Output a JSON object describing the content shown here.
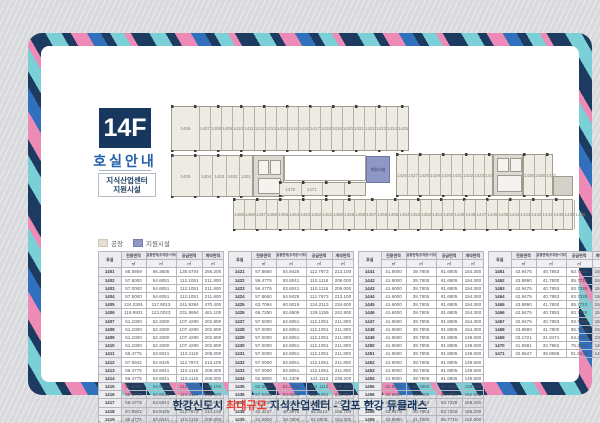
{
  "header": {
    "floor": "14F",
    "subtitle": "호실안내",
    "box_line1": "지식산업센터",
    "box_line2": "지원시설"
  },
  "legend": {
    "items": [
      {
        "label": "공장",
        "color": "#e6e0d2"
      },
      {
        "label": "지원시설",
        "color": "#8f97c5"
      }
    ]
  },
  "plan": {
    "support_label": "지원시설",
    "bands": {
      "top": [
        "1406",
        "1407",
        "1408",
        "1409",
        "1410",
        "1411",
        "1412",
        "1413",
        "1414",
        "1415",
        "1416",
        "1417",
        "1418",
        "1419",
        "1420",
        "1421",
        "1422",
        "1423",
        "1424",
        "1425"
      ],
      "mid_left": [
        "1405",
        "1404",
        "1403",
        "1402",
        "1401"
      ],
      "mid_right_a": [
        "1426",
        "1427",
        "1428",
        "1429",
        "1430",
        "1431",
        "1432",
        "1433",
        "1434"
      ],
      "mid_right_b": [
        "1435",
        "1436",
        "1437"
      ],
      "strip": [
        "1470",
        "1471",
        "",
        ""
      ],
      "bottom": [
        "1469",
        "1468",
        "1467",
        "1466",
        "1465",
        "1464",
        "1463",
        "1462",
        "1461",
        "1460",
        "1459",
        "1458",
        "1457",
        "1456",
        "1455",
        "1454",
        "1453",
        "1452",
        "1451",
        "1450",
        "1449",
        "1448",
        "1447",
        "1446",
        "1445",
        "1444",
        "1443",
        "1442",
        "1441",
        "1440",
        "1439",
        "1438"
      ]
    }
  },
  "table_header": {
    "room": "호실",
    "cols": [
      {
        "label": "전용면적",
        "unit": "㎡"
      },
      {
        "label": "공용면적(주차장+기타)",
        "unit": "㎡"
      },
      {
        "label": "공급면적",
        "unit": "㎡"
      },
      {
        "label": "계약면적",
        "unit": "㎡"
      }
    ]
  },
  "tables": [
    {
      "rows": [
        [
          "1401",
          "65.5869",
          "66.3605",
          "135.6704",
          "256.200"
        ],
        [
          "1402",
          "57.5000",
          "54.6051",
          "112.1051",
          "211.800"
        ],
        [
          "1403",
          "57.0000",
          "54.6051",
          "112.1051",
          "211.800"
        ],
        [
          "1404",
          "57.5000",
          "54.6051",
          "112.1051",
          "211.800"
        ],
        [
          "1405",
          "124.0391",
          "117.9013",
          "241.9394",
          "470.400"
        ],
        [
          "1406",
          "119.9931",
          "113.0023",
          "231.9954",
          "461.100"
        ],
        [
          "1407",
          "51.1000",
          "52.3290",
          "107.4290",
          "202.900"
        ],
        [
          "1408",
          "51.1000",
          "52.3290",
          "107.4290",
          "202.900"
        ],
        [
          "1409",
          "51.1000",
          "52.3290",
          "107.4290",
          "202.900"
        ],
        [
          "1410",
          "51.1000",
          "52.3290",
          "107.4290",
          "202.900"
        ],
        [
          "1411",
          "56.4775",
          "53.6041",
          "110.1116",
          "208.000"
        ],
        [
          "1412",
          "57.8942",
          "54.9425",
          "112.7973",
          "213.100"
        ],
        [
          "1413",
          "56.4775",
          "53.6041",
          "110.1116",
          "208.000"
        ],
        [
          "1414",
          "56.4775",
          "53.6041",
          "110.1116",
          "208.000"
        ],
        [
          "1415",
          "57.8942",
          "54.9425",
          "112.7973",
          "213.100"
        ],
        [
          "1416",
          "56.4775",
          "53.6041",
          "110.1116",
          "208.000"
        ],
        [
          "1417",
          "56.4775",
          "53.6041",
          "110.1116",
          "208.000"
        ],
        [
          "1418",
          "57.8942",
          "54.9425",
          "112.7973",
          "213.100"
        ],
        [
          "1419",
          "56.4775",
          "53.6041",
          "110.1116",
          "208.000"
        ],
        [
          "1420",
          "56.4775",
          "53.6041",
          "110.1116",
          "208.000"
        ]
      ]
    },
    {
      "rows": [
        [
          "1421",
          "57.8660",
          "54.9425",
          "112.7973",
          "213.100"
        ],
        [
          "1422",
          "56.4775",
          "53.6041",
          "110.1116",
          "208.000"
        ],
        [
          "1423",
          "56.4775",
          "53.6041",
          "110.1116",
          "208.000"
        ],
        [
          "1424",
          "57.8660",
          "54.9425",
          "112.7973",
          "213.100"
        ],
        [
          "1425",
          "63.7094",
          "60.5019",
          "124.2113",
          "234.600"
        ],
        [
          "1426",
          "66.7250",
          "62.6909",
          "129.1159",
          "242.900"
        ],
        [
          "1427",
          "57.5000",
          "54.6051",
          "112.1051",
          "211.800"
        ],
        [
          "1428",
          "57.0000",
          "54.6051",
          "112.1051",
          "211.800"
        ],
        [
          "1429",
          "57.0000",
          "54.6051",
          "112.1051",
          "211.800"
        ],
        [
          "1430",
          "57.0000",
          "54.6051",
          "112.1051",
          "211.800"
        ],
        [
          "1431",
          "57.0000",
          "54.6051",
          "112.1051",
          "211.800"
        ],
        [
          "1432",
          "57.0000",
          "54.6051",
          "112.1051",
          "211.800"
        ],
        [
          "1433",
          "57.0000",
          "54.6051",
          "112.1051",
          "211.800"
        ],
        [
          "1434",
          "62.6805",
          "61.4308",
          "124.1113",
          "236.200"
        ],
        [
          "1435",
          "62.6805",
          "61.4308",
          "124.1113",
          "236.200"
        ],
        [
          "1436",
          "57.5000",
          "54.6051",
          "112.1051",
          "211.800"
        ],
        [
          "1437",
          "65.6706",
          "62.3544",
          "128.0250",
          "241.900"
        ],
        [
          "1438",
          "42.4237",
          "40.3976",
          "82.8213",
          "156.700"
        ],
        [
          "1439",
          "41.9000",
          "39.7805",
          "81.6805",
          "154.300"
        ],
        [
          "1440",
          "41.9000",
          "39.7805",
          "81.6805",
          "154.300"
        ]
      ]
    },
    {
      "rows": [
        [
          "1441",
          "41.9000",
          "39.7805",
          "81.6805",
          "154.300"
        ],
        [
          "1442",
          "41.9000",
          "39.7805",
          "81.6805",
          "154.300"
        ],
        [
          "1443",
          "41.9000",
          "39.7805",
          "81.6805",
          "154.300"
        ],
        [
          "1444",
          "41.9000",
          "39.7805",
          "81.6805",
          "154.300"
        ],
        [
          "1445",
          "41.9000",
          "39.7805",
          "81.6805",
          "154.300"
        ],
        [
          "1446",
          "41.9000",
          "39.7805",
          "81.6805",
          "154.300"
        ],
        [
          "1447",
          "41.9000",
          "39.7805",
          "81.6805",
          "154.300"
        ],
        [
          "1448",
          "41.9000",
          "39.7805",
          "81.6805",
          "154.300"
        ],
        [
          "1449",
          "41.9000",
          "39.7805",
          "81.6805",
          "149.500"
        ],
        [
          "1450",
          "41.9000",
          "39.7805",
          "81.6805",
          "149.500"
        ],
        [
          "1451",
          "41.9000",
          "39.7805",
          "81.6805",
          "149.500"
        ],
        [
          "1452",
          "41.9000",
          "39.7805",
          "81.6805",
          "149.500"
        ],
        [
          "1453",
          "41.9000",
          "39.7805",
          "81.6805",
          "149.500"
        ],
        [
          "1454",
          "41.9000",
          "39.7805",
          "81.6805",
          "149.500"
        ],
        [
          "1455",
          "42.9475",
          "40.7853",
          "83.7328",
          "158.200"
        ],
        [
          "1456",
          "43.8890",
          "41.7800",
          "85.7710",
          "162.000"
        ],
        [
          "1457",
          "42.9475",
          "40.7853",
          "83.7328",
          "158.200"
        ],
        [
          "1458",
          "42.9475",
          "40.7853",
          "83.7328",
          "158.200"
        ],
        [
          "1459",
          "43.8890",
          "41.7800",
          "85.7710",
          "162.000"
        ],
        [
          "1460",
          "42.9475",
          "40.7853",
          "83.7328",
          "158.200"
        ]
      ]
    },
    {
      "rows": [
        [
          "1461",
          "42.9475",
          "40.7853",
          "83.7328",
          "158.200"
        ],
        [
          "1462",
          "43.8890",
          "41.7800",
          "85.7710",
          "162.000"
        ],
        [
          "1463",
          "42.9475",
          "40.7853",
          "83.7328",
          "158.200"
        ],
        [
          "1464",
          "42.9475",
          "40.7853",
          "83.7328",
          "158.200"
        ],
        [
          "1465",
          "43.8890",
          "41.7800",
          "85.7710",
          "162.000"
        ],
        [
          "1466",
          "42.9475",
          "40.7853",
          "83.7328",
          "158.200"
        ],
        [
          "1467",
          "42.9475",
          "40.7853",
          "83.7328",
          "158.200"
        ],
        [
          "1468",
          "43.8890",
          "41.7800",
          "85.7710",
          "162.000"
        ],
        [
          "1469",
          "33.1721",
          "31.0471",
          "64.2192",
          "130.200"
        ],
        [
          "1470",
          "41.5581",
          "33.7862",
          "75.3443",
          "140.800"
        ],
        [
          "1471",
          "42.5547",
          "39.0699",
          "81.6246",
          "141.100"
        ]
      ]
    }
  ],
  "footnote": "※ 상기 호실안내 평면도는 소비자의 이해를 돕기 위한 것으로 실제와 다소 차이가 있을 수 있습니다.  ※ 상기 면적은 인허가 및 설계변경 등에 따라 변경될 수 있습니다. (단위:㎡)",
  "footer": {
    "part1": "한강신도시 ",
    "highlight": "최대규모",
    "part2": " 지식산업센터 - ",
    "brand": "김포 한강 듀클래스"
  },
  "colors": {
    "navy": "#17375e",
    "stripe_pink": "#ee8ab6",
    "stripe_cyan": "#7bd0d8",
    "stripe_blue": "#3170bd",
    "factory_fill": "#edebe4",
    "support_fill": "#8f97c5",
    "accent_red": "#e8392f"
  }
}
